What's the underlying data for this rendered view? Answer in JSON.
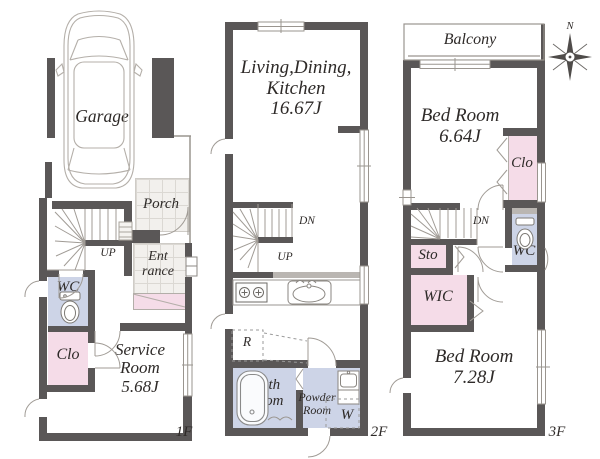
{
  "palette": {
    "wall": "#5a5757",
    "pink": "#f5dce8",
    "lavender": "#cdd4e7",
    "tile": "#f2f0ed",
    "tile_line": "#dbd8d3",
    "band": "#bab6b2",
    "line": "#9a958f",
    "text": "#2e2a28"
  },
  "floor1": {
    "label": "1F",
    "garage": "Garage",
    "porch": "Porch",
    "up": "UP",
    "entrance": "Ent\nrance",
    "wc": "WC",
    "clo": "Clo",
    "service_room": "Service\nRoom\n5.68J"
  },
  "floor2": {
    "label": "2F",
    "ldk": "Living,Dining,\nKitchen\n16.67J",
    "dn": "DN",
    "up": "UP",
    "refrigerator": "R",
    "bath_room": "Bath\nRoom",
    "powder_room": "Powder\nRoom",
    "washer": "W"
  },
  "floor3": {
    "label": "3F",
    "balcony": "Balcony",
    "bed_room_1": "Bed Room\n6.64J",
    "clo": "Clo",
    "dn": "DN",
    "sto": "Sto",
    "wc": "WC",
    "wic": "WIC",
    "bed_room_2": "Bed Room\n7.28J",
    "compass_north": "N"
  }
}
